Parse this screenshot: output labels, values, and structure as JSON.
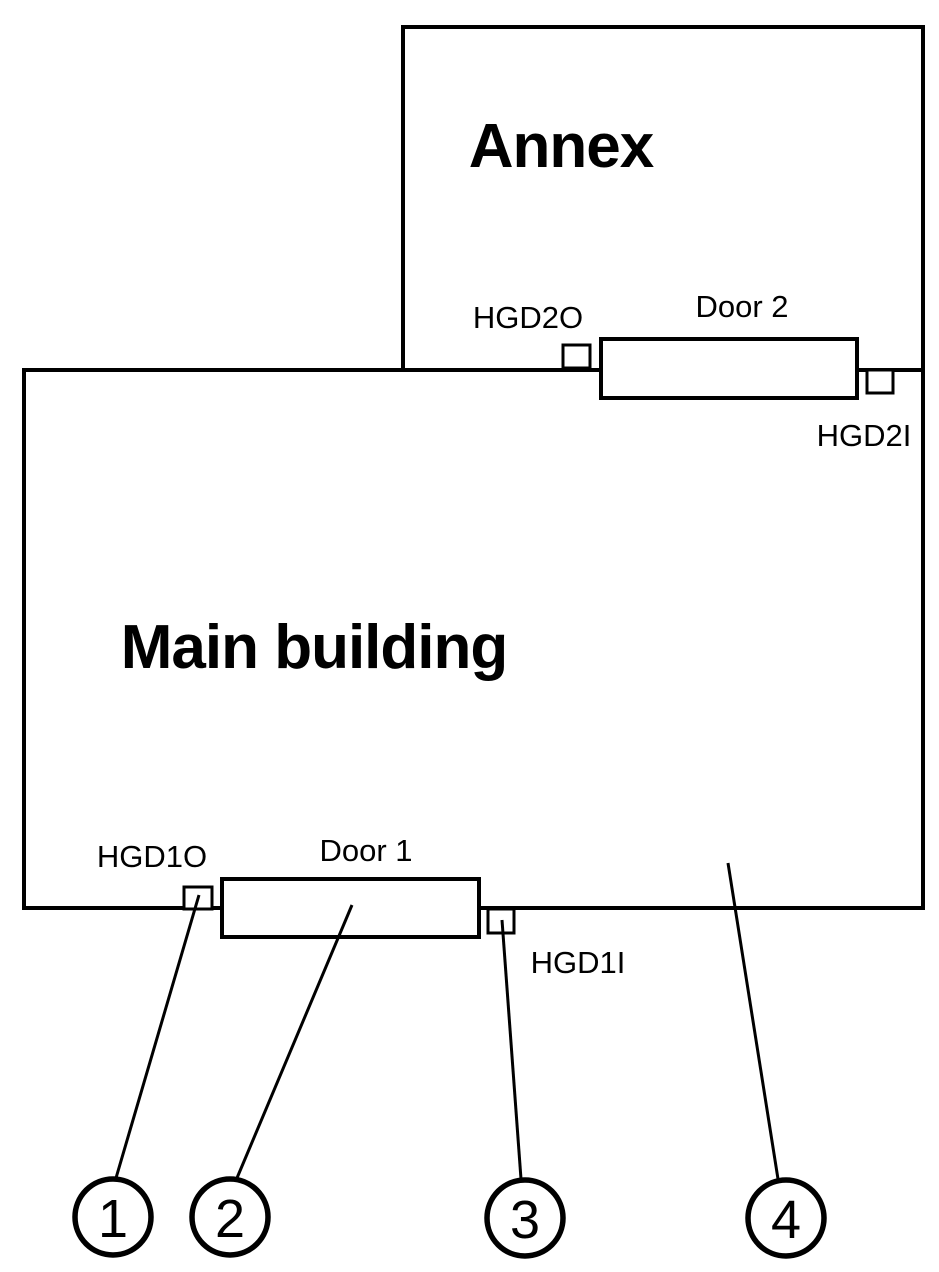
{
  "diagram": {
    "buildings": [
      {
        "name": "Main building"
      },
      {
        "name": "Annex"
      }
    ],
    "doors": [
      {
        "label": "Door 1"
      },
      {
        "label": "Door 2"
      }
    ],
    "devices": [
      {
        "label": "HGD1O"
      },
      {
        "label": "HGD1I"
      },
      {
        "label": "HGD2O"
      },
      {
        "label": "HGD2I"
      }
    ],
    "callouts": [
      {
        "number": "1"
      },
      {
        "number": "2"
      },
      {
        "number": "3"
      },
      {
        "number": "4"
      }
    ],
    "colors": {
      "stroke": "#000000",
      "background": "#ffffff"
    }
  }
}
